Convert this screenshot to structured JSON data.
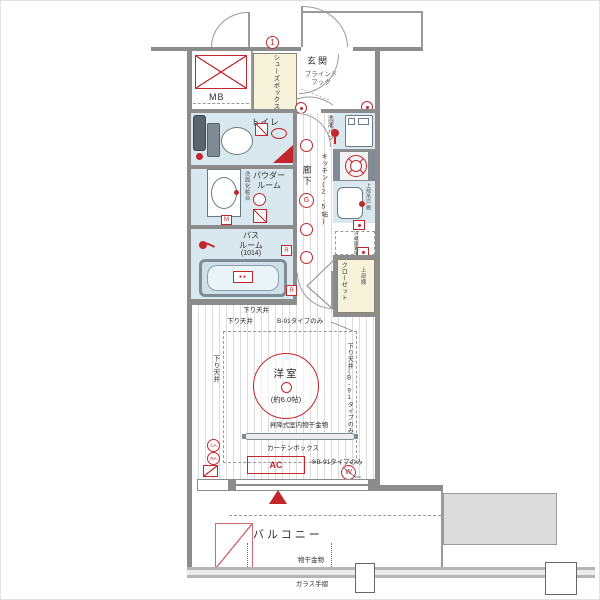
{
  "colors": {
    "accent_red": "#c1272d",
    "wall_gray": "#8c8c8c",
    "wet_blue": "#d9e8ee",
    "storage_cream": "#f7f2da"
  },
  "common": {
    "floor_marker": "1",
    "mb": "MB",
    "shoes_box": "シューズボックス",
    "entrance": "玄関",
    "blind_hook_1": "ブラインド",
    "blind_hook_2": "フック"
  },
  "sanitary": {
    "toilet": "トイレ",
    "powder_1": "パウダー",
    "powder_2": "ルーム",
    "vanity": "洗面化粧台",
    "bath_1": "バス",
    "bath_2": "ルーム",
    "bath_size": "(1014)",
    "laundry_pan": "洗濯パン",
    "m": "M",
    "r": "R"
  },
  "corridor": {
    "label": "廊下",
    "g": "G",
    "r": "R"
  },
  "kitchen": {
    "label": "キッチン(2.5帖)",
    "upper_cabinet": "上部吊戸棚",
    "fridge": "冷蔵庫置場"
  },
  "closet": {
    "label": "クローゼット",
    "upper_shelf": "上部棚"
  },
  "room": {
    "name": "洋室",
    "size": "(約6.0帖)",
    "dc_top": "下り天井",
    "dc_note_l": "下り天井",
    "dc_note_r": "B-91タイプのみ",
    "dc_left": "下り天井",
    "dc_right": "下り天井(B-91タイプのみ)",
    "hoist": "昇降式室内物干金物",
    "curtain": "カーテンボックス",
    "ac": "AC",
    "type_note": "※B-91タイプのみ",
    "ca": "CA",
    "ra": "RA",
    "w": "W"
  },
  "balcony": {
    "label": "バルコニー",
    "drying": "物干金物",
    "glass_rail": "ガラス手摺"
  }
}
